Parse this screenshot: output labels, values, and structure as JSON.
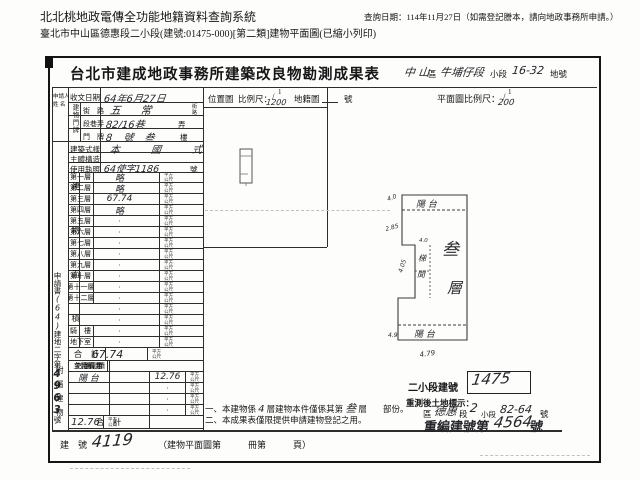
{
  "system_header": {
    "title": "北北桃地政電傳全功能地籍資料查詢系統",
    "query_date": "查詢日期：114年11月27日（如需登記謄本，請向地政事務所申請。）",
    "subtitle": "臺北市中山區德惠段二小段(建號:01475-000)[第二類]建物平面圖(已縮小列印)"
  },
  "form": {
    "title": "台北市建成地政事務所建築改良物勘測成果表",
    "header_fields": {
      "district_hand": "中 山",
      "district_label": "區",
      "section_hand": "牛埔仔段",
      "subsection_label": "小段",
      "parcel_hand": "16-32",
      "parcel_label": "地號"
    },
    "applicant": {
      "label_line1": "申請人",
      "label_line2": "姓 名"
    },
    "receipt": {
      "label": "收文日期",
      "value": "64年6月27日"
    },
    "address": {
      "group_label": "建物門牌",
      "row1_label": "街　路",
      "row1_value": "五 常",
      "row1_unit_top": "街",
      "row1_unit_bottom": "路",
      "row2_label": "段巷弄",
      "row2_value": "82/16巷",
      "row2_suffix": "弄",
      "row3_label": "門　牌",
      "row3_value": "8 號 叁",
      "row3_suffix": "樓"
    },
    "style": {
      "label": "建築式樣",
      "value": "本 國 式"
    },
    "structure": {
      "label": "主體構造",
      "value": ""
    },
    "license": {
      "label": "使用執照",
      "value": "64使字1186",
      "suffix": "號"
    },
    "area_group_label": "建物面積",
    "unit_line1": "平方",
    "unit_line2": "公尺",
    "floors": [
      {
        "label": "第一層",
        "value": "略",
        "hand": true
      },
      {
        "label": "第二層",
        "value": "略",
        "hand": true
      },
      {
        "label": "第三層",
        "value": "67.74",
        "hand": true
      },
      {
        "label": "第四層",
        "value": "略",
        "hand": true
      },
      {
        "label": "第五層",
        "value": "·"
      },
      {
        "label": "第六層",
        "value": "·"
      },
      {
        "label": "第七層",
        "value": "·"
      },
      {
        "label": "第八層",
        "value": "·"
      },
      {
        "label": "第九層",
        "value": "·"
      },
      {
        "label": "第十層",
        "value": "·"
      },
      {
        "label": "第十一層",
        "value": "·"
      },
      {
        "label": "第十二層",
        "value": "·"
      },
      {
        "label": "",
        "value": "·"
      },
      {
        "label": "",
        "value": "·"
      },
      {
        "label": "騎　樓",
        "value": "·"
      },
      {
        "label": "地下室",
        "value": "·"
      }
    ],
    "total": {
      "label": "合　計",
      "value": "67.74"
    },
    "application_no": {
      "prefix": "申請書",
      "hand1": "(64)",
      "mid": "建地二字第",
      "hand2": "4963",
      "suffix": "號"
    },
    "annex": {
      "group_label": "附屬建物",
      "headers": [
        "使用種類",
        "主體構造",
        "面　積"
      ],
      "rows": [
        {
          "use": "陽 台",
          "structure": "",
          "area": "12.76",
          "hand": true
        },
        {
          "use": "",
          "structure": "",
          "area": "·"
        },
        {
          "use": "",
          "structure": "",
          "area": "·"
        },
        {
          "use": "",
          "structure": "",
          "area": "·"
        }
      ],
      "total_label": "合　計",
      "total_value": "12.76"
    },
    "building_no": {
      "label": "建　號",
      "value": "4119"
    },
    "location_map": {
      "label": "位置圖",
      "scale_label": "比例尺：",
      "numerator": "1",
      "denominator": "1200",
      "cadastre_label": "地籍圖",
      "no_label": "號"
    },
    "floor_plan": {
      "scale_label": "平面圖比例尺：",
      "numerator": "1",
      "denominator": "200",
      "balcony_top": "陽 台",
      "balcony_bottom": "陽 台",
      "floor_char1": "叁",
      "floor_char2": "層",
      "stair_char1": "梯",
      "stair_char2": "間",
      "dim_top": "4.0",
      "dim_left": "2.85",
      "dim_mid_a": "4.05",
      "dim_mid_b": "4.0",
      "dim_bottom_left": "4.9",
      "dim_bottom": "4.79"
    },
    "notes": {
      "n1_p1": "一、本建物係",
      "n1_h1": "4",
      "n1_p2": "層建物本件僅係其第",
      "n1_h2": "叁",
      "n1_p3": "層",
      "n1_p4": "部份。",
      "n2": "二、本成果表僅限提供申請建物登記之用。",
      "book_ref": "（建物平面圖第　　　冊第　　　頁）"
    },
    "resurvey": {
      "subsection_label": "二小段建號",
      "subsection_value": "1475",
      "remark_label": "重測後土地標示：",
      "district_label": "區",
      "section_hand": "德惠",
      "section_label": "段",
      "subsection_hand": "2",
      "subsection_label2": "小段",
      "parcel_hand": "82-64",
      "parcel_no_label": "號",
      "renumber_prefix": "重編建號第",
      "renumber_hand": "4564",
      "renumber_suffix": "號"
    }
  }
}
